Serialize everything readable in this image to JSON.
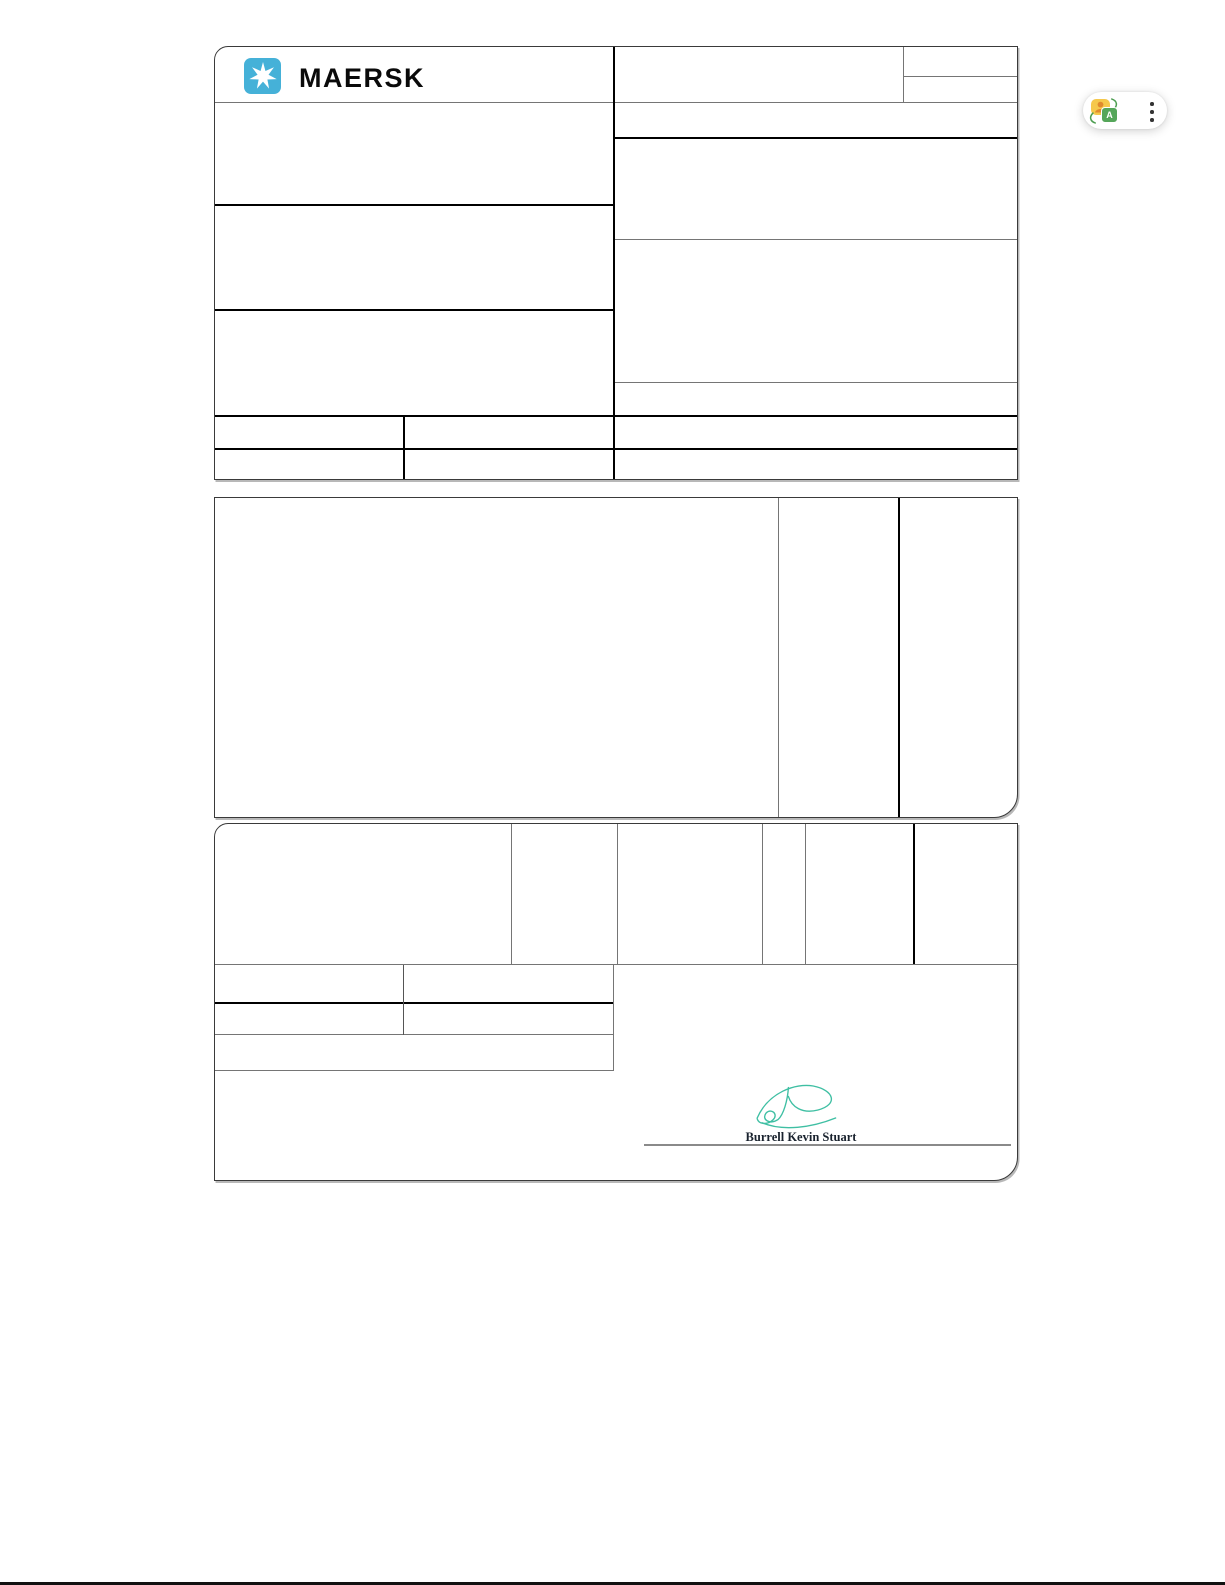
{
  "page": {
    "background": "#FFFFFF",
    "bottom_bar_color": "#111111"
  },
  "document": {
    "brand": {
      "logo_text": "MAERSK",
      "star_color": "#45B1D8",
      "wordmark_color": "#0A0A0A"
    },
    "form": {
      "grid_line_color": "#757575",
      "emphasis_line_color": "#000000",
      "border_color": "#3A3A3A"
    },
    "signature": {
      "name": "Burrell Kevin Stuart",
      "ink_color": "#3FBFA3",
      "name_color": "#19222E"
    }
  },
  "overlay_widget": {
    "background": "#FFFFFF",
    "translate_letter": "A",
    "colors": {
      "yellow": "#F5C84C",
      "green": "#55A65A",
      "figure": "#E08A2E",
      "arrows": "#4E9E52",
      "dots": "#333333"
    }
  }
}
